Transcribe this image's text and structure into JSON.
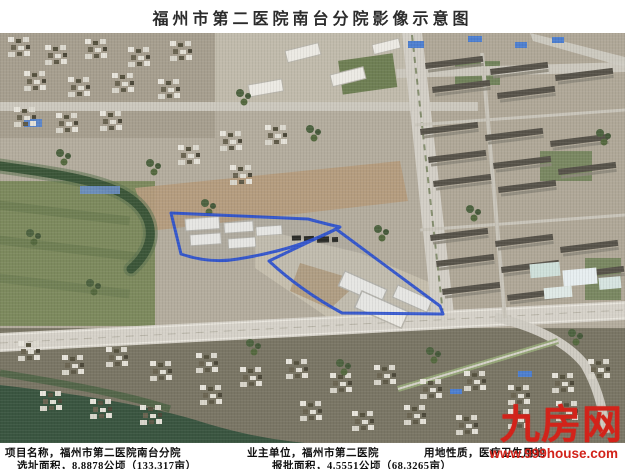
{
  "title": "福州市第二医院南台分院影像示意图",
  "footer": {
    "sep": "，",
    "line1": [
      {
        "label": "项目名称",
        "value": "福州市第二医院南台分院"
      },
      {
        "label": "业主单位",
        "value": "福州市第二医院"
      },
      {
        "label": "用地性质",
        "value": "医疗卫生用地"
      }
    ],
    "line2": [
      {
        "label": "选址面积",
        "value": "8.8878公顷（133.317亩）"
      },
      {
        "label": "报批面积",
        "value": "4.5551公顷（68.3265亩）"
      }
    ]
  },
  "watermark": {
    "brand": "九房网",
    "url": "www.999house.com",
    "color": "#d2231a"
  },
  "map": {
    "type": "satellite-photo",
    "site_outline_color": "#2b50cf"
  }
}
